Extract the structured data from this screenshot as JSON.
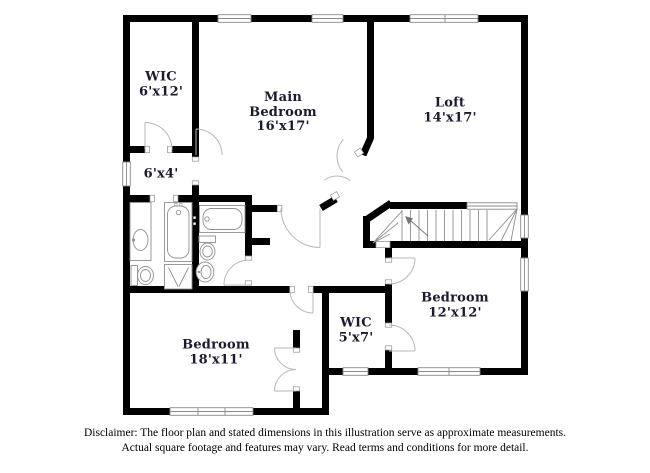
{
  "floorplan": {
    "rooms": [
      {
        "key": "wic_upper",
        "name": "WIC",
        "dims": "6'x12'"
      },
      {
        "key": "main_bedroom",
        "name": "Main Bedroom",
        "dims": "16'x17'"
      },
      {
        "key": "loft",
        "name": "Loft",
        "dims": "14'x17'"
      },
      {
        "key": "hall",
        "name": "",
        "dims": "6'x4'"
      },
      {
        "key": "bedroom_right",
        "name": "Bedroom",
        "dims": "12'x12'"
      },
      {
        "key": "wic_lower",
        "name": "WIC",
        "dims": "5'x7'"
      },
      {
        "key": "bedroom_lower",
        "name": "Bedroom",
        "dims": "18'x11'"
      }
    ],
    "disclaimer": {
      "line1": "Disclaimer: The floor plan and stated dimensions in this illustration serve as approximate measurements.",
      "line2": "Actual square footage and features may vary. Read terms and conditions for more detail."
    },
    "colors": {
      "wall": "#000000",
      "background": "#ffffff",
      "window_border": "#8a8a8a",
      "door_arc": "#b8b8b8",
      "fixture_outline": "#909090",
      "label_text": "#1b1b30"
    }
  }
}
